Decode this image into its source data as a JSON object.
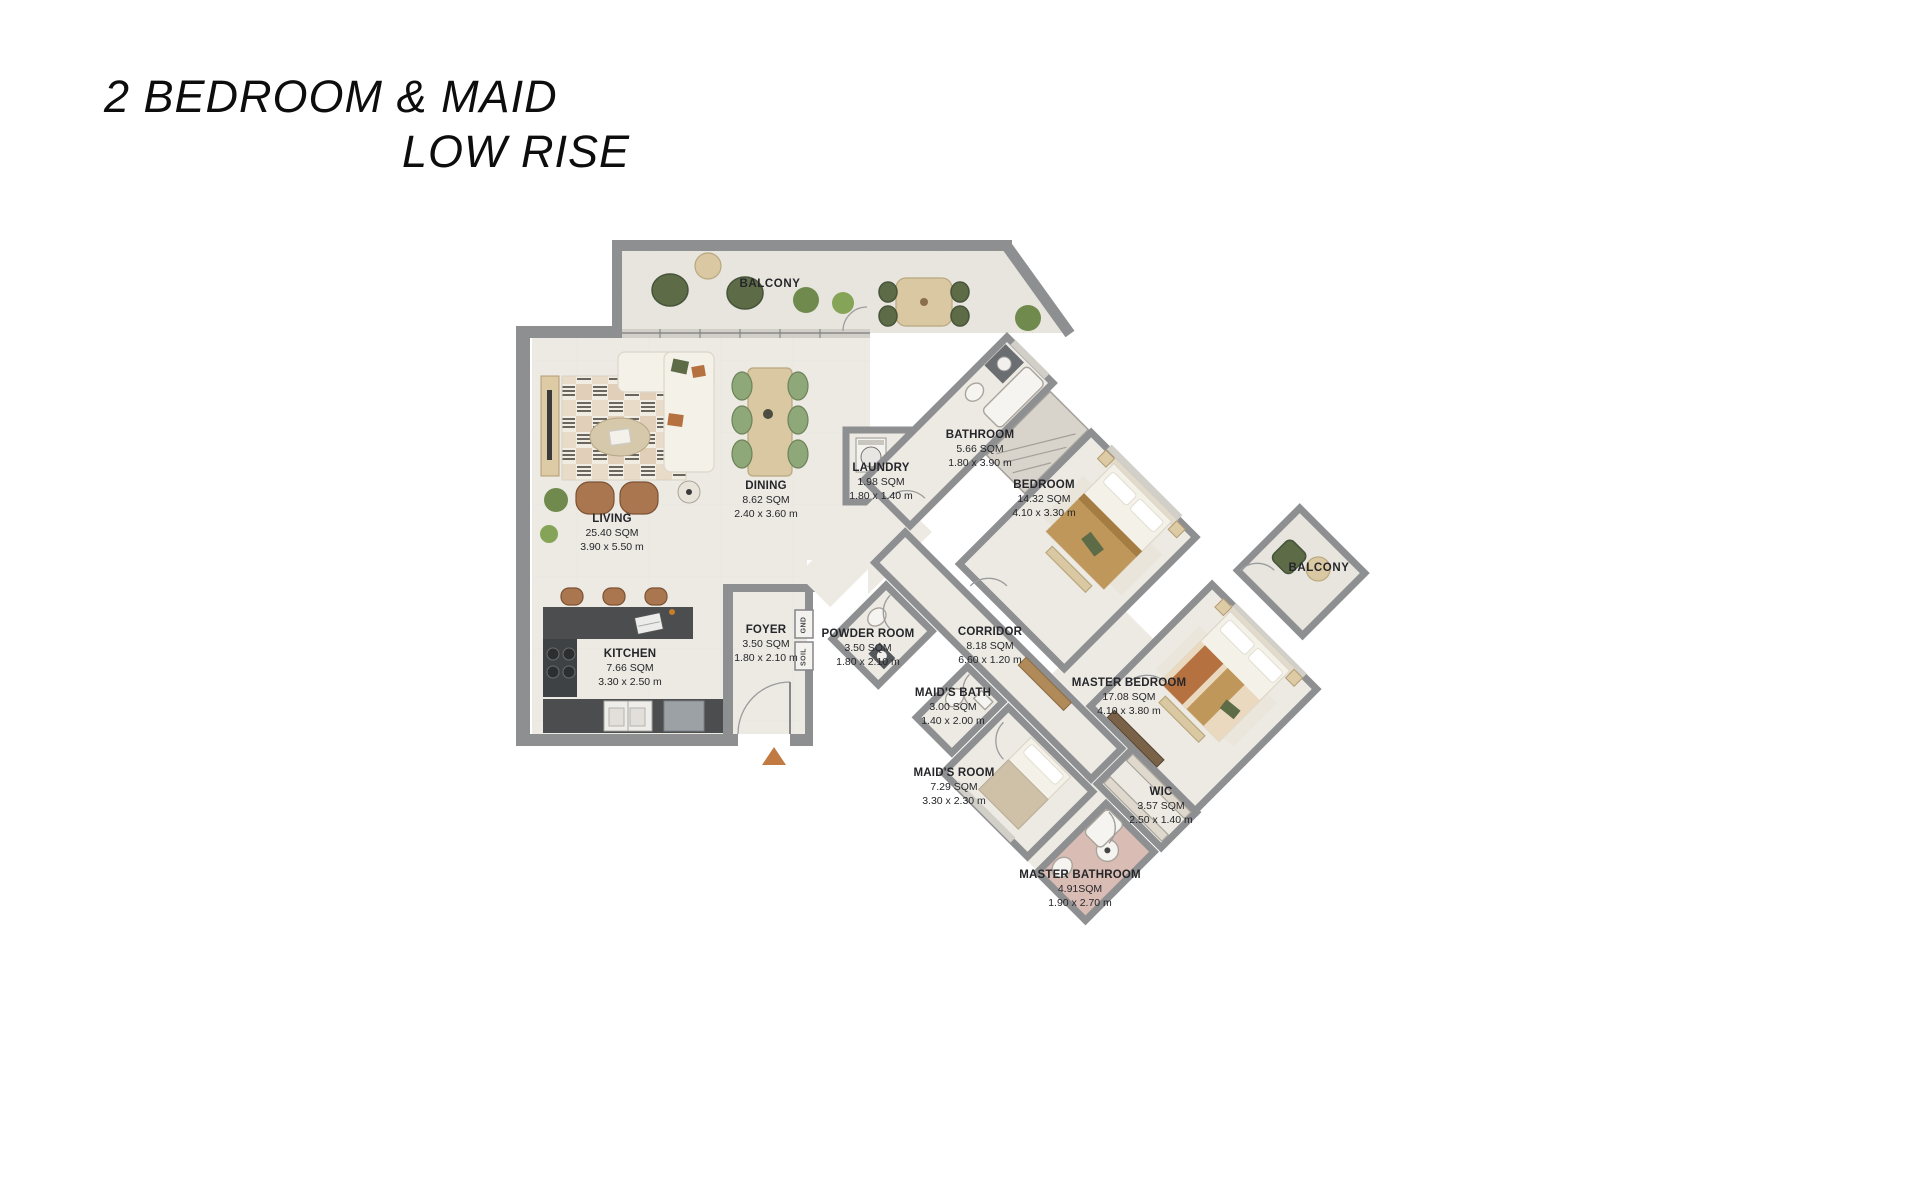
{
  "title": {
    "line1": "2 BEDROOM & MAID",
    "line2": "LOW RISE"
  },
  "plan": {
    "balconies": [
      {
        "id": "balcony-top",
        "label": "BALCONY"
      },
      {
        "id": "balcony-right",
        "label": "BALCONY"
      }
    ],
    "shafts": [
      {
        "label": "GND"
      },
      {
        "label": "SOIL"
      }
    ],
    "rooms": [
      {
        "id": "living",
        "name": "LIVING",
        "area": "25.40 SQM",
        "dims": "3.90 x 5.50 m"
      },
      {
        "id": "dining",
        "name": "DINING",
        "area": "8.62 SQM",
        "dims": "2.40 x 3.60 m"
      },
      {
        "id": "laundry",
        "name": "LAUNDRY",
        "area": "1.98 SQM",
        "dims": "1.80 x 1.40 m"
      },
      {
        "id": "bathroom",
        "name": "BATHROOM",
        "area": "5.66 SQM",
        "dims": "1.80 x 3.90 m"
      },
      {
        "id": "bedroom",
        "name": "BEDROOM",
        "area": "14.32 SQM",
        "dims": "4.10 x 3.30 m"
      },
      {
        "id": "kitchen",
        "name": "KITCHEN",
        "area": "7.66 SQM",
        "dims": "3.30 x 2.50 m"
      },
      {
        "id": "foyer",
        "name": "FOYER",
        "area": "3.50 SQM",
        "dims": "1.80 x 2.10 m"
      },
      {
        "id": "powder-room",
        "name": "POWDER ROOM",
        "area": "3.50 SQM",
        "dims": "1.80 x 2.10 m"
      },
      {
        "id": "corridor",
        "name": "CORRIDOR",
        "area": "8.18 SQM",
        "dims": "6.60 x 1.20 m"
      },
      {
        "id": "maids-bath",
        "name": "MAID'S BATH",
        "area": "3.00 SQM",
        "dims": "1.40 x 2.00 m"
      },
      {
        "id": "maids-room",
        "name": "MAID'S ROOM",
        "area": "7.29 SQM",
        "dims": "3.30 x 2.30 m"
      },
      {
        "id": "master-bedroom",
        "name": "MASTER BEDROOM",
        "area": "17.08 SQM",
        "dims": "4.10 x 3.80 m"
      },
      {
        "id": "wic",
        "name": "WIC",
        "area": "3.57 SQM",
        "dims": "2.50 x 1.40 m"
      },
      {
        "id": "master-bathroom",
        "name": "MASTER BATHROOM",
        "area": "4.91SQM",
        "dims": "1.90 x 2.70 m"
      }
    ],
    "colors": {
      "wall": "#8e8f91",
      "floor": "#edeae4",
      "balcony_floor": "#e8e5de",
      "counter": "#4b4d4f",
      "wood": "#d9c8a2",
      "green": "#5d6c47",
      "rust": "#b5713f",
      "tan": "#c0975a",
      "bath_pink": "#d9bdb4",
      "arrow": "#c07a42"
    }
  }
}
